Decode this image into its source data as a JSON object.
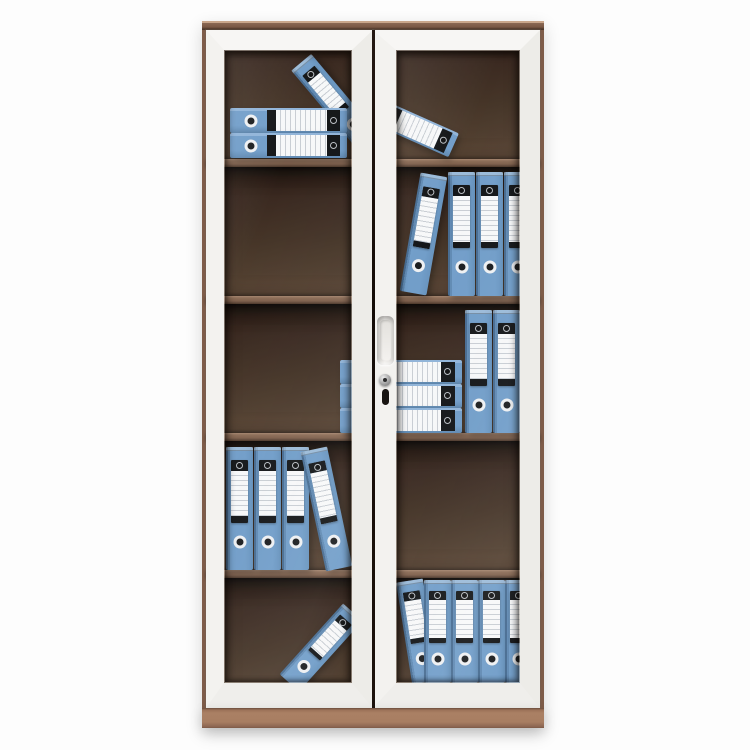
{
  "meta": {
    "description": "Product photo of a tall two-door steel filing cabinet with framed glass doors, five shelf compartments and blue lever-arch binders arranged upright, leaning and stacked flat",
    "scene_type": "product-photo",
    "text_content": "none"
  },
  "palette": {
    "background": "#fdfdfd",
    "frame_white": "#f2f1ee",
    "trim_brown": "#7e5c49",
    "base_brown": "#a87e62",
    "interior_dark": "#32231a",
    "shelf_brown": "#7c5d49",
    "binder_blue": "#6f9cc8",
    "binder_blue_dark": "#44698f",
    "binder_blue_light": "#8fb3d8",
    "label_white": "#f7f8f9",
    "band_black": "#101214"
  },
  "cabinet": {
    "doors": 2,
    "shelf_compartments": 5,
    "binder_count": 23,
    "interior": {
      "x": 206,
      "y": 30,
      "w": 334,
      "h": 678
    },
    "shelf_y": [
      159,
      296,
      433,
      570
    ],
    "shelf_h": 8,
    "compartment_tops": [
      30,
      167,
      304,
      441,
      578
    ],
    "compartment_bottoms": [
      159,
      296,
      433,
      570,
      708
    ],
    "hardware": {
      "handle": {
        "x": 377,
        "y": 316,
        "w": 17,
        "h": 49
      },
      "keyhole_cap": {
        "x": 379,
        "y": 374,
        "d": 12
      },
      "keyhole_slot": {
        "x": 382,
        "y": 389,
        "w": 7,
        "h": 16
      }
    }
  },
  "binders": [
    {
      "type": "upright",
      "x": 322,
      "y": 50,
      "w": 26,
      "h": 105,
      "rot": -40,
      "note": "tilted behind flat stack, top-left compartment"
    },
    {
      "type": "horizontal",
      "x": 230,
      "y": 108,
      "w": 117,
      "h": 25,
      "rot": 0,
      "note": "flat stack top, shelf 1 left"
    },
    {
      "type": "horizontal",
      "x": 230,
      "y": 133,
      "w": 117,
      "h": 25,
      "rot": 0,
      "note": "flat stack bottom, shelf 1 left"
    },
    {
      "type": "horizontal",
      "x": 358,
      "y": 112,
      "w": 100,
      "h": 26,
      "rot": 24,
      "note": "fallen diagonal, shelf 1 right"
    },
    {
      "type": "upright",
      "x": 448,
      "y": 172,
      "w": 27,
      "h": 124,
      "rot": 0,
      "note": "shelf 2 right"
    },
    {
      "type": "upright",
      "x": 476,
      "y": 172,
      "w": 27,
      "h": 124,
      "rot": 0,
      "note": "shelf 2 right"
    },
    {
      "type": "upright",
      "x": 504,
      "y": 172,
      "w": 27,
      "h": 124,
      "rot": 0,
      "note": "shelf 2 right, cut by frame"
    },
    {
      "type": "upright",
      "x": 410,
      "y": 174,
      "w": 27,
      "h": 120,
      "rot": 10,
      "note": "leaning, shelf 2 right"
    },
    {
      "type": "horizontal",
      "x": 340,
      "y": 360,
      "w": 122,
      "h": 24,
      "rot": 0,
      "note": "flat stack, shelf 3 center"
    },
    {
      "type": "horizontal",
      "x": 340,
      "y": 384,
      "w": 122,
      "h": 24,
      "rot": 0,
      "note": "flat stack, shelf 3 center"
    },
    {
      "type": "horizontal",
      "x": 340,
      "y": 408,
      "w": 122,
      "h": 25,
      "rot": 0,
      "note": "flat stack, shelf 3 center"
    },
    {
      "type": "upright",
      "x": 465,
      "y": 310,
      "w": 27,
      "h": 123,
      "rot": 0,
      "note": "shelf 3 right"
    },
    {
      "type": "upright",
      "x": 493,
      "y": 310,
      "w": 27,
      "h": 123,
      "rot": 0,
      "note": "shelf 3 right"
    },
    {
      "type": "upright",
      "x": 226,
      "y": 447,
      "w": 27,
      "h": 123,
      "rot": 0,
      "note": "shelf 4 left"
    },
    {
      "type": "upright",
      "x": 254,
      "y": 447,
      "w": 27,
      "h": 123,
      "rot": 0,
      "note": "shelf 4 left"
    },
    {
      "type": "upright",
      "x": 282,
      "y": 447,
      "w": 27,
      "h": 123,
      "rot": 0,
      "note": "shelf 4 left"
    },
    {
      "type": "upright",
      "x": 313,
      "y": 448,
      "w": 27,
      "h": 122,
      "rot": -12,
      "note": "leaning, shelf 4 left"
    },
    {
      "type": "upright",
      "x": 308,
      "y": 600,
      "w": 26,
      "h": 95,
      "rot": 42,
      "note": "fallen diagonal, bottom left"
    },
    {
      "type": "upright",
      "x": 404,
      "y": 580,
      "w": 27,
      "h": 103,
      "rot": -9,
      "note": "leaning, bottom right"
    },
    {
      "type": "upright",
      "x": 424,
      "y": 580,
      "w": 27,
      "h": 103,
      "rot": 0,
      "note": "bottom right"
    },
    {
      "type": "upright",
      "x": 451,
      "y": 580,
      "w": 27,
      "h": 103,
      "rot": 0,
      "note": "bottom right"
    },
    {
      "type": "upright",
      "x": 478,
      "y": 580,
      "w": 27,
      "h": 103,
      "rot": 0,
      "note": "bottom right"
    },
    {
      "type": "upright",
      "x": 505,
      "y": 580,
      "w": 27,
      "h": 103,
      "rot": 0,
      "note": "bottom right, cut by frame"
    }
  ]
}
